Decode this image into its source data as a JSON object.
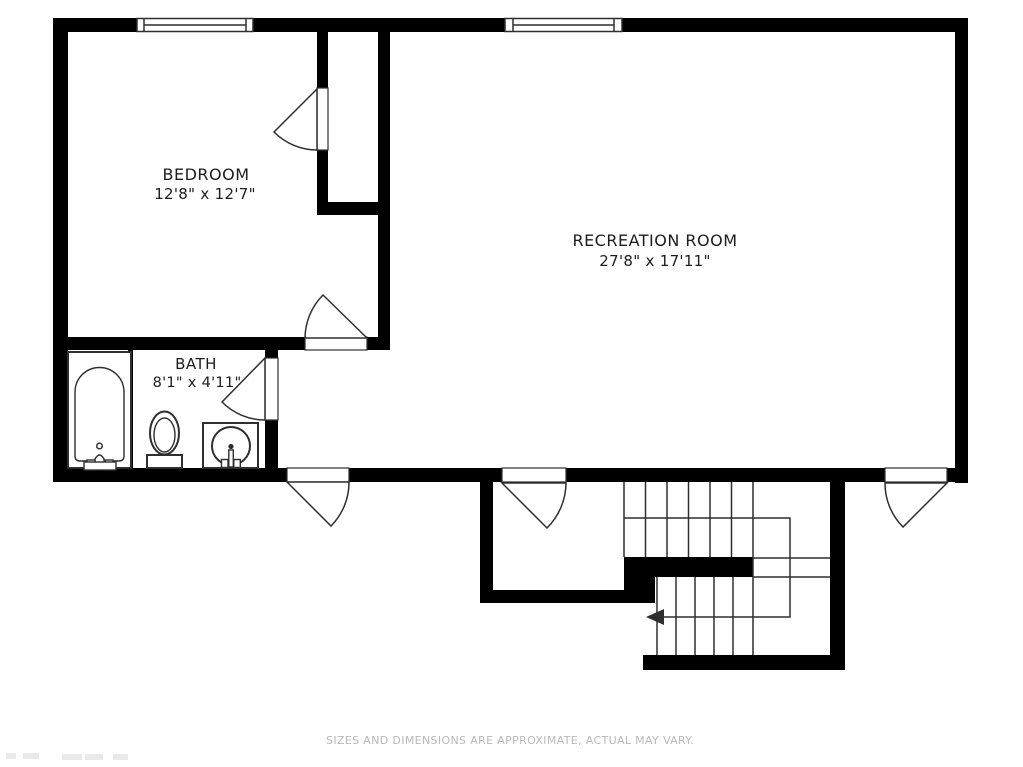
{
  "colors": {
    "wall": "#000000",
    "line": "#2f2f2f",
    "label": "#1d1d1d",
    "footer": "#b9b9b9",
    "background": "#ffffff"
  },
  "rooms": [
    {
      "id": "bedroom",
      "name": "BEDROOM",
      "dimensions": "12'8\" x 12'7\""
    },
    {
      "id": "recreation-room",
      "name": "RECREATION ROOM",
      "dimensions": "27'8\" x 17'11\""
    },
    {
      "id": "bath",
      "name": "BATH",
      "dimensions": "8'1\" x 4'11\""
    }
  ],
  "footer": {
    "note": "SIZES AND DIMENSIONS ARE APPROXIMATE, ACTUAL MAY VARY."
  }
}
